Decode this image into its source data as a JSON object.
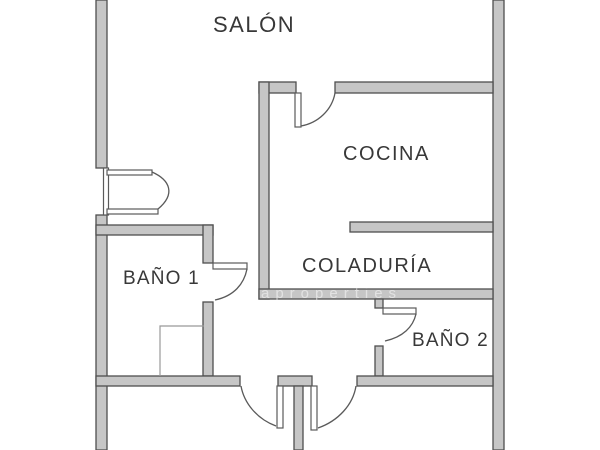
{
  "plan": {
    "title_hint": "apartment floor plan",
    "rooms": [
      {
        "name": "salon",
        "label": "SALÓN"
      },
      {
        "name": "cocina",
        "label": "COCINA"
      },
      {
        "name": "coladuria",
        "label": "COLADURÍA"
      },
      {
        "name": "bano1",
        "label": "BAÑO 1"
      },
      {
        "name": "bano2",
        "label": "BAÑO 2"
      }
    ],
    "watermark": "aproperties",
    "colors": {
      "wall_fill": "#c6c6c6",
      "wall_outline": "#4f4f4f",
      "door_line": "#5a5a5a",
      "label_text": "#383838",
      "fixture_line": "#999999",
      "background": "#ffffff"
    }
  }
}
